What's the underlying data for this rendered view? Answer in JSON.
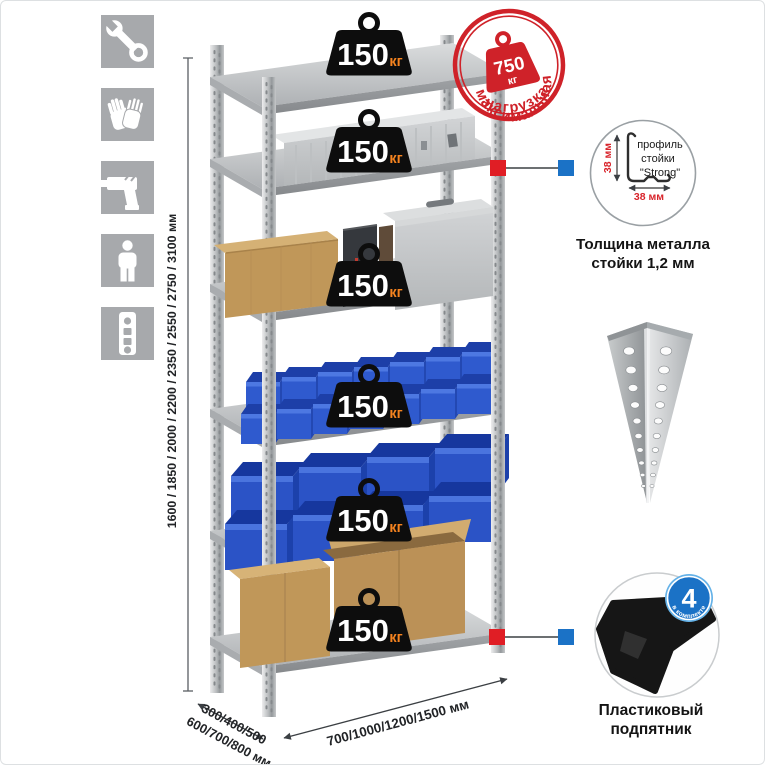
{
  "sidebar_icons": [
    {
      "name": "wrench-icon"
    },
    {
      "name": "gloves-icon"
    },
    {
      "name": "drill-icon"
    },
    {
      "name": "person-icon"
    },
    {
      "name": "level-icon"
    }
  ],
  "dimensions": {
    "height_label": "1600 / 1850 / 2000 / 2200 / 2350 / 2550 / 2750 / 3100 мм",
    "depth_label_line1": "300/400/500",
    "depth_label_line2": "600/700/800 мм",
    "width_label": "700/1000/1200/1500 мм"
  },
  "shelf_badge": {
    "value": "150",
    "unit": "кг"
  },
  "max_load_stamp": {
    "arc_top": "максимальная",
    "arc_bottom": "нагрузка",
    "value": "750",
    "unit": "кг"
  },
  "profile_detail": {
    "vertical_dim": "38 мм",
    "horizontal_dim": "38 мм",
    "label_line1": "профиль",
    "label_line2": "стойки",
    "label_line3": "\"Strong\"",
    "caption_line1": "Толщина металла",
    "caption_line2": "стойки 1,2 мм"
  },
  "foot_detail": {
    "badge_value": "4",
    "badge_arc": "в комплекте",
    "caption_line1": "Пластиковый",
    "caption_line2": "подпятник"
  },
  "colors": {
    "stamp_red": "#cf2229",
    "badge_black": "#0d0d0d",
    "badge_unit_orange": "#f5831f",
    "bin_blue": "#2b53c6",
    "connector_red": "#e01e25",
    "connector_blue": "#1b72c6",
    "icon_gray": "#a7a9ac",
    "metal_gray": "#c4c7c9",
    "cardboard": "#c09759"
  }
}
